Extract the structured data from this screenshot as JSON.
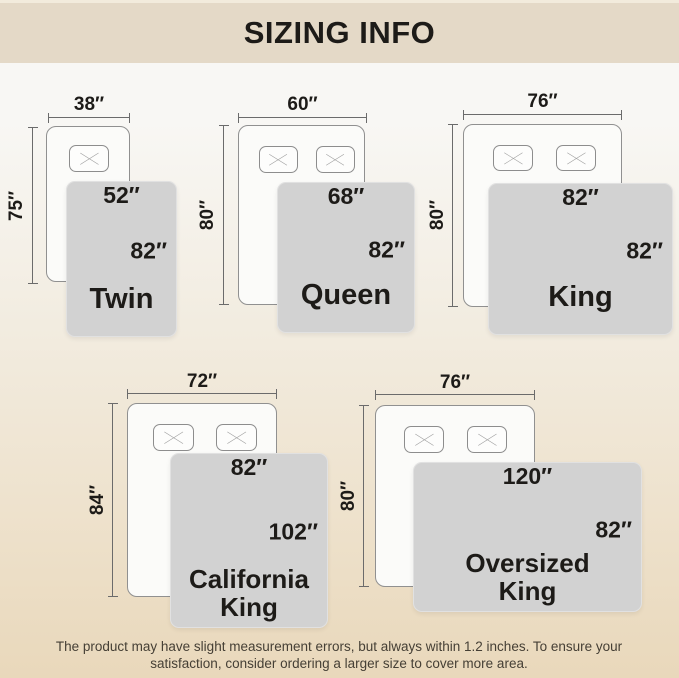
{
  "header": {
    "title": "SIZING INFO"
  },
  "sizes": [
    {
      "name": "Twin",
      "bed_width": "38″",
      "bed_length": "75″",
      "blanket_width": "52″",
      "blanket_length": "82″"
    },
    {
      "name": "Queen",
      "bed_width": "60″",
      "bed_length": "80″",
      "blanket_width": "68″",
      "blanket_length": "82″"
    },
    {
      "name": "King",
      "bed_width": "76″",
      "bed_length": "80″",
      "blanket_width": "82″",
      "blanket_length": "82″"
    },
    {
      "name": "California King",
      "bed_width": "72″",
      "bed_length": "84″",
      "blanket_width": "82″",
      "blanket_length": "102″"
    },
    {
      "name": "Oversized King",
      "bed_width": "76″",
      "bed_length": "80″",
      "blanket_width": "120″",
      "blanket_length": "82″"
    }
  ],
  "footer": {
    "note": "The product may have slight measurement errors, but always within 1.2 inches. To ensure your satisfaction, consider ordering a larger size to cover more area."
  },
  "colors": {
    "header_bg": "#e4d9c7",
    "blanket_gray": "#d2d2d2",
    "dimension_line": "#6b6b6b",
    "text": "#1d1b18"
  }
}
